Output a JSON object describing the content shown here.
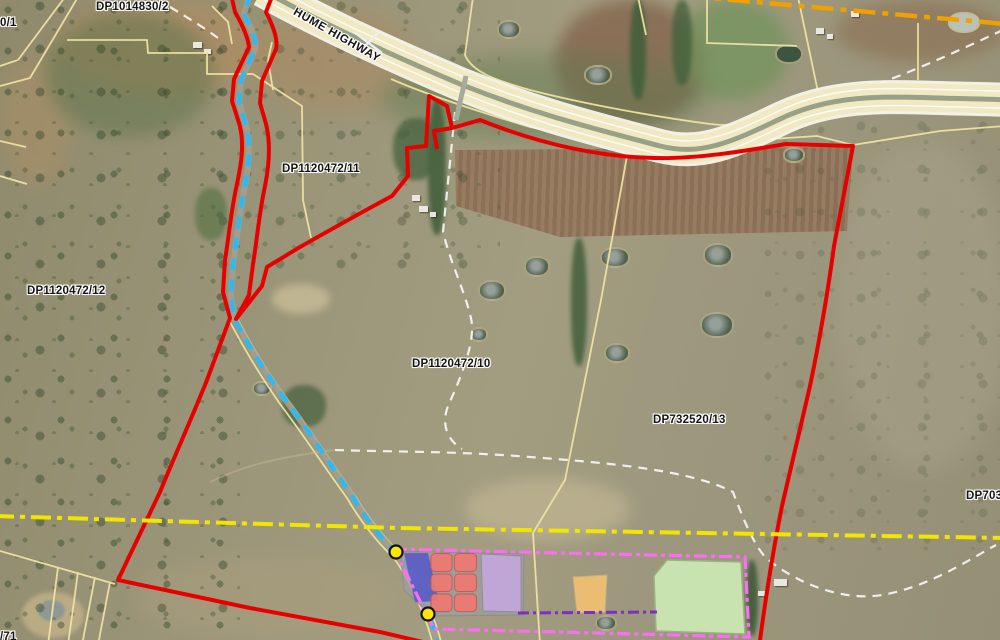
{
  "labels": {
    "lot_0_1": "0/1",
    "dp1014830_2": "DP1014830/2",
    "hume_highway": "HUME HIGHWAY",
    "dp1120472_11": "DP1120472/11",
    "dp1120472_12": "DP1120472/12",
    "dp1120472_10": "DP1120472/10",
    "dp732520_13": "DP732520/13",
    "dp703_partial": "DP7035",
    "lot_71_partial": "/71"
  },
  "line_styles": {
    "subject_boundary_color": "#e60000",
    "watercourse_color": "#2fb9f2",
    "cadastre_line_color": "#efe2a2",
    "yellow_dashdot_color": "#f2e600",
    "orange_dashdot_color": "#f0a000",
    "development_boundary_color": "#fb6ef2",
    "purple_line_color": "#7b2fc4",
    "track_color": "#ffffff"
  },
  "zones": {
    "pad_color": "#9e9e9e",
    "blue_color": "#5a5ec6",
    "cell_color": "#ed7a72",
    "cell_count": 6,
    "lavender_color": "#c2a7dd",
    "orange_color": "#f2c173",
    "green_color": "#cdeab5"
  },
  "markers": {
    "fill": "#ffe800",
    "stroke": "#111111",
    "count": 2
  }
}
